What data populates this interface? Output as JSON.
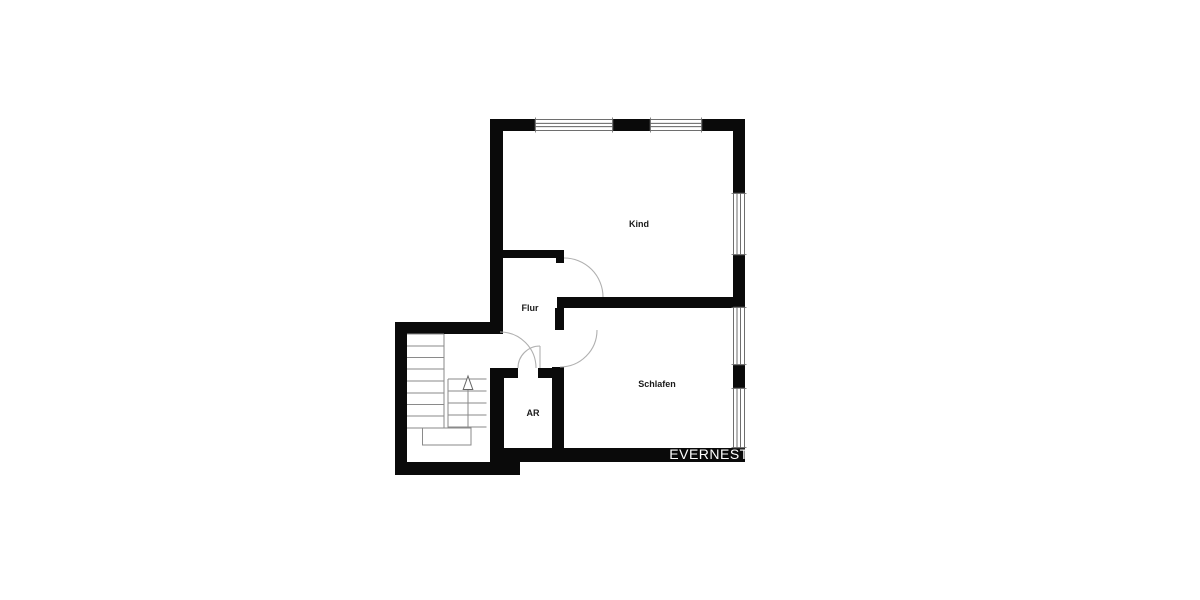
{
  "floor_plan": {
    "rooms": {
      "kind": {
        "label": "Kind"
      },
      "flur": {
        "label": "Flur"
      },
      "schlafen": {
        "label": "Schlafen"
      },
      "ar": {
        "label": "AR"
      }
    },
    "watermark": {
      "text": "EVERNEST"
    },
    "icons": {
      "stairs_direction": "up-arrow"
    },
    "colors": {
      "background": "#ffffff",
      "wall": "#0a0a0a",
      "thin_line": "#8a8a8a",
      "window_frame": "#4a4a4a",
      "door_arc": "#b0b0b0",
      "label_text": "#1a1a1a",
      "watermark_text": "#ffffff"
    }
  }
}
